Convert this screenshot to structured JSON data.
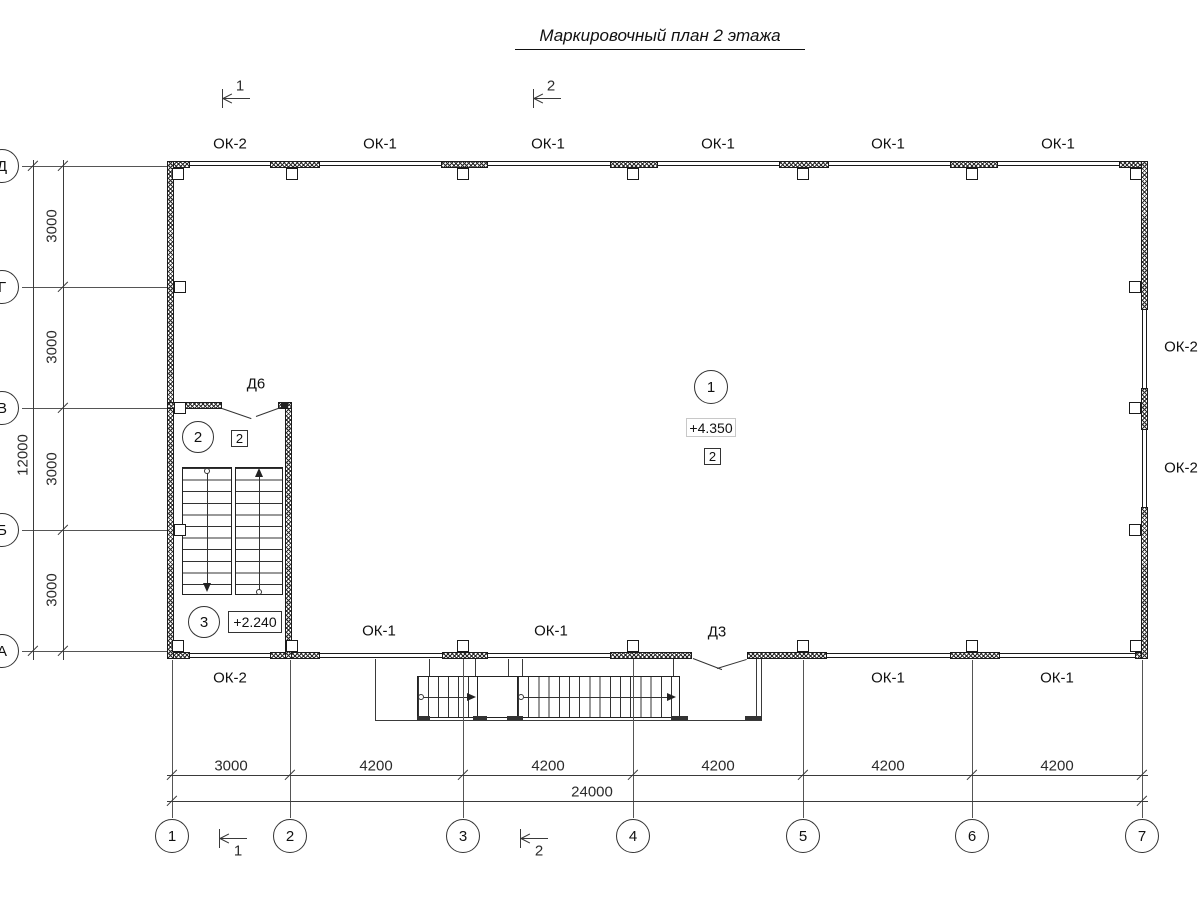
{
  "title": "Маркировочный план 2 этажа",
  "section_marks": {
    "top": [
      "1",
      "2"
    ],
    "bottom": [
      "1",
      "2"
    ]
  },
  "labels": {
    "top": [
      "ОК-2",
      "ОК-1",
      "ОК-1",
      "ОК-1",
      "ОК-1",
      "ОК-1"
    ],
    "bottom_inner": [
      "ОК-1",
      "ОК-1"
    ],
    "bottom_outer": [
      "ОК-2",
      "ОК-1",
      "ОК-1"
    ],
    "right": [
      "ОК-2",
      "ОК-2"
    ],
    "door_stair": "Д6",
    "door_bottom": "Д3"
  },
  "markers": {
    "room1": {
      "number": "1",
      "elevation": "+4.350",
      "finish": "2"
    },
    "room2": {
      "number": "2",
      "finish": "2"
    },
    "room3": {
      "number": "3",
      "elevation": "+2.240"
    }
  },
  "axes": {
    "cols": [
      "1",
      "2",
      "3",
      "4",
      "5",
      "6",
      "7"
    ],
    "rows": [
      "Д",
      "Г",
      "В",
      "Б",
      "А"
    ]
  },
  "dims": {
    "bottom": [
      "3000",
      "4200",
      "4200",
      "4200",
      "4200",
      "4200"
    ],
    "bottom_total": "24000",
    "left": [
      "3000",
      "3000",
      "3000",
      "3000"
    ],
    "left_total": "12000"
  }
}
